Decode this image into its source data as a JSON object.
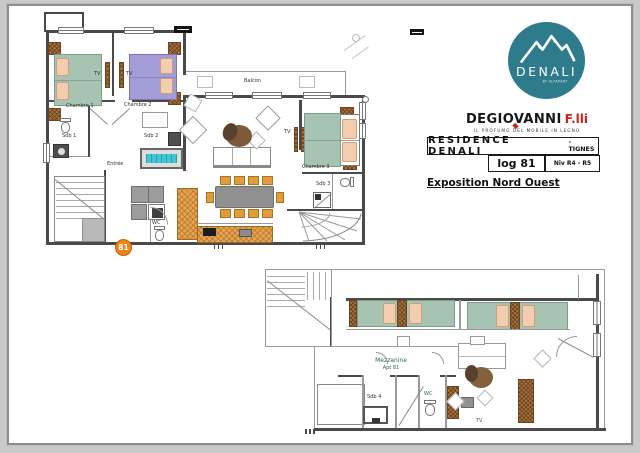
{
  "header": {
    "logo": {
      "text": "DENALI",
      "subtext": "BY ALPAPART"
    },
    "brand": {
      "name": "DEGIOVANNI",
      "suffix": "F.lli",
      "tagline": "IL PROFUMO DEL MOBILE IN LEGNO"
    },
    "title_block": {
      "residence": "RESIDENCE DENALI",
      "location": "- TIGNES",
      "unit": "log 81",
      "level": "Niv R4 - R5"
    },
    "exposition": "Exposition Nord Ouest"
  },
  "main_plan": {
    "labels": {
      "balcon": "Balcon",
      "chambre1": "Chambre 1",
      "chambre2": "Chambre 2",
      "chambre3": "Chambre 3",
      "sdb1": "Sdb 1",
      "sdb2": "Sdb 2",
      "sdb3": "Sdb 3",
      "entree": "Entrée",
      "wc": "WC",
      "tv1": "TV",
      "tv2": "TV",
      "tv3": "TV",
      "badge": "81"
    }
  },
  "mezzanine_plan": {
    "labels": {
      "title1": "Mezzanine",
      "title2": "Apt 81",
      "sdb4": "Sdb 4",
      "wc": "WC",
      "tv": "TV"
    }
  },
  "colors": {
    "logo_teal": "#2e7b8c",
    "brand_red": "#c2271c",
    "bed_green": "#a7c3b2",
    "bed_purple": "#a39cd6",
    "pillow_peach": "#f3cdb0",
    "wood_brown": "#a9743e",
    "chair_orange": "#e39b3d",
    "bathtub_cyan": "#43c6d3",
    "badge_orange": "#ee8418",
    "table_gray": "#909090"
  }
}
